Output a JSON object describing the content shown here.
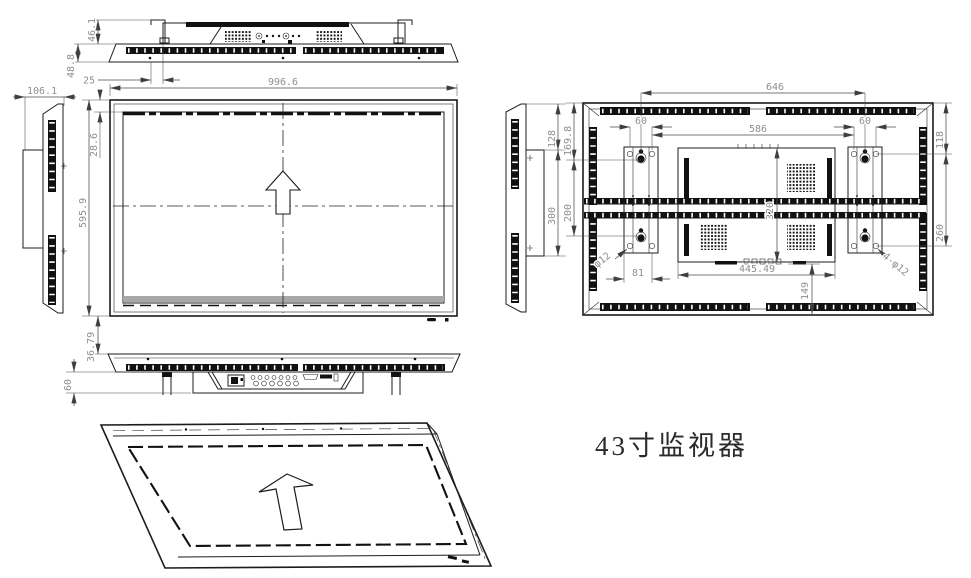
{
  "title": "43寸监视器",
  "colors": {
    "line": "#1c1c1c",
    "dim_text": "#8f8f8f",
    "background": "#ffffff"
  },
  "dims": {
    "top": {
      "bracket_height": "46.1",
      "panel_thickness": "48.8",
      "hook_offset": "25",
      "side_depth": "106.1"
    },
    "front": {
      "width": "996.6",
      "top_bezel": "28.6",
      "height": "595.9"
    },
    "bottom": {
      "panel_gap": "36.79",
      "terminal_box_height": "60"
    },
    "rear_side": {
      "top_to_plate": "128",
      "plate_height": "300"
    },
    "rear": {
      "hole_span_outer": "646",
      "hole_span_inner": "586",
      "bracket_pitch_left": "60",
      "bracket_pitch_right": "60",
      "top_to_hole_left": "169.8",
      "hole_pitch_left": "200",
      "top_to_hole_right": "118",
      "hole_pitch_right": "260",
      "box_height": "320",
      "bracket_width": "81",
      "box_width": "445.49",
      "box_to_bottom": "149",
      "hole_diameter": "φ12",
      "hole_callout": "4-φ12"
    }
  }
}
